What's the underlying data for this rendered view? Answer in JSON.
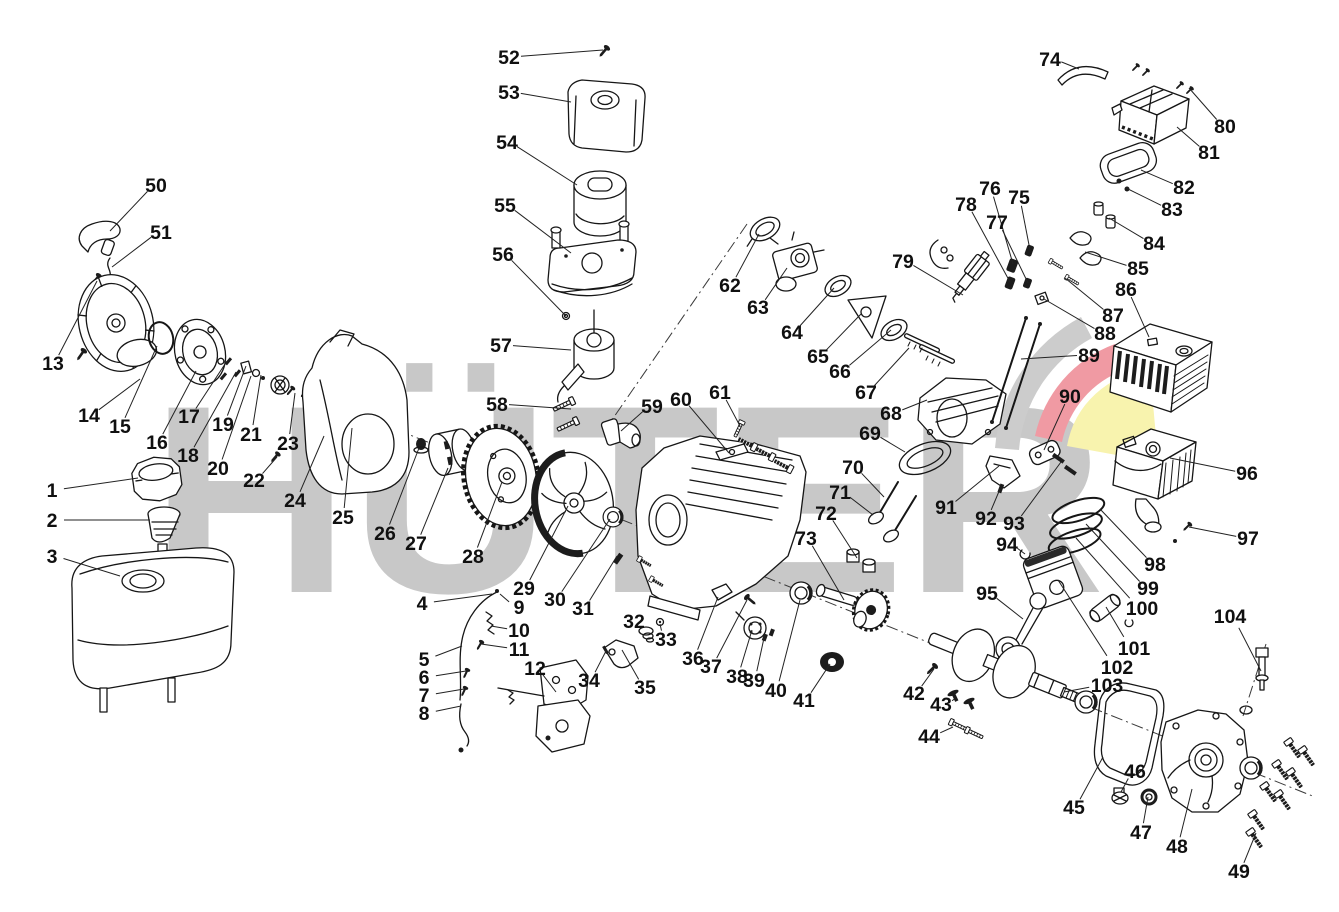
{
  "watermark": {
    "text": "HÜTER",
    "letter_color": "#c8c8c8",
    "fan_gray": "#cccccc",
    "fan_red": "#f09aa3",
    "fan_yellow": "#f8f3ae"
  },
  "diagram": {
    "type": "exploded-parts-diagram",
    "subject": "small gasoline engine",
    "background": "#ffffff",
    "line_color": "#161616",
    "part_count": 104
  },
  "labels": [
    {
      "n": "1",
      "x": 52,
      "y": 490,
      "tx": 138,
      "ty": 478
    },
    {
      "n": "2",
      "x": 52,
      "y": 520,
      "tx": 150,
      "ty": 520
    },
    {
      "n": "3",
      "x": 52,
      "y": 556,
      "tx": 120,
      "ty": 576
    },
    {
      "n": "4",
      "x": 422,
      "y": 603,
      "tx": 492,
      "ty": 594
    },
    {
      "n": "5",
      "x": 424,
      "y": 659,
      "tx": 462,
      "ty": 646
    },
    {
      "n": "6",
      "x": 424,
      "y": 677,
      "tx": 466,
      "ty": 671
    },
    {
      "n": "7",
      "x": 424,
      "y": 695,
      "tx": 464,
      "ty": 689
    },
    {
      "n": "8",
      "x": 424,
      "y": 713,
      "tx": 461,
      "ty": 706
    },
    {
      "n": "9",
      "x": 519,
      "y": 607,
      "tx": 500,
      "ty": 594
    },
    {
      "n": "10",
      "x": 519,
      "y": 630,
      "tx": 491,
      "ty": 626
    },
    {
      "n": "11",
      "x": 519,
      "y": 649,
      "tx": 481,
      "ty": 644
    },
    {
      "n": "12",
      "x": 535,
      "y": 668,
      "tx": 556,
      "ty": 692
    },
    {
      "n": "13",
      "x": 53,
      "y": 363,
      "tx": 97,
      "ty": 281
    },
    {
      "n": "14",
      "x": 89,
      "y": 415,
      "tx": 140,
      "ty": 379
    },
    {
      "n": "15",
      "x": 120,
      "y": 426,
      "tx": 157,
      "ty": 346
    },
    {
      "n": "16",
      "x": 157,
      "y": 442,
      "tx": 196,
      "ty": 371
    },
    {
      "n": "17",
      "x": 189,
      "y": 416,
      "tx": 227,
      "ty": 361
    },
    {
      "n": "18",
      "x": 188,
      "y": 455,
      "tx": 236,
      "ty": 372
    },
    {
      "n": "19",
      "x": 223,
      "y": 424,
      "tx": 246,
      "ty": 366
    },
    {
      "n": "20",
      "x": 218,
      "y": 468,
      "tx": 251,
      "ty": 376
    },
    {
      "n": "21",
      "x": 251,
      "y": 434,
      "tx": 261,
      "ty": 375
    },
    {
      "n": "22",
      "x": 254,
      "y": 480,
      "tx": 277,
      "ty": 457
    },
    {
      "n": "23",
      "x": 288,
      "y": 443,
      "tx": 295,
      "ty": 393
    },
    {
      "n": "24",
      "x": 295,
      "y": 500,
      "tx": 324,
      "ty": 436
    },
    {
      "n": "25",
      "x": 343,
      "y": 517,
      "tx": 352,
      "ty": 428
    },
    {
      "n": "26",
      "x": 385,
      "y": 533,
      "tx": 419,
      "ty": 448
    },
    {
      "n": "27",
      "x": 416,
      "y": 543,
      "tx": 448,
      "ty": 468
    },
    {
      "n": "28",
      "x": 473,
      "y": 556,
      "tx": 502,
      "ty": 482
    },
    {
      "n": "29",
      "x": 524,
      "y": 588,
      "tx": 568,
      "ty": 506
    },
    {
      "n": "30",
      "x": 555,
      "y": 599,
      "tx": 610,
      "ty": 519
    },
    {
      "n": "31",
      "x": 583,
      "y": 608,
      "tx": 617,
      "ty": 556
    },
    {
      "n": "32",
      "x": 634,
      "y": 621,
      "tx": 645,
      "ty": 632
    },
    {
      "n": "33",
      "x": 666,
      "y": 639,
      "tx": 660,
      "ty": 624
    },
    {
      "n": "34",
      "x": 589,
      "y": 680,
      "tx": 606,
      "ty": 651
    },
    {
      "n": "35",
      "x": 645,
      "y": 687,
      "tx": 622,
      "ty": 650
    },
    {
      "n": "36",
      "x": 693,
      "y": 658,
      "tx": 718,
      "ty": 597
    },
    {
      "n": "37",
      "x": 711,
      "y": 666,
      "tx": 747,
      "ty": 600
    },
    {
      "n": "38",
      "x": 737,
      "y": 676,
      "tx": 752,
      "ty": 630
    },
    {
      "n": "39",
      "x": 754,
      "y": 680,
      "tx": 764,
      "ty": 638
    },
    {
      "n": "40",
      "x": 776,
      "y": 690,
      "tx": 800,
      "ty": 600
    },
    {
      "n": "41",
      "x": 804,
      "y": 700,
      "tx": 830,
      "ty": 664
    },
    {
      "n": "42",
      "x": 914,
      "y": 693,
      "tx": 934,
      "ty": 669
    },
    {
      "n": "43",
      "x": 941,
      "y": 704,
      "tx": 956,
      "ty": 698
    },
    {
      "n": "44",
      "x": 929,
      "y": 736,
      "tx": 953,
      "ty": 727
    },
    {
      "n": "45",
      "x": 1074,
      "y": 807,
      "tx": 1103,
      "ty": 757
    },
    {
      "n": "46",
      "x": 1135,
      "y": 771,
      "tx": 1121,
      "ty": 792
    },
    {
      "n": "47",
      "x": 1141,
      "y": 832,
      "tx": 1148,
      "ty": 797
    },
    {
      "n": "48",
      "x": 1177,
      "y": 846,
      "tx": 1192,
      "ty": 789
    },
    {
      "n": "49",
      "x": 1239,
      "y": 871,
      "tx": 1256,
      "ty": 833
    },
    {
      "n": "50",
      "x": 156,
      "y": 185,
      "tx": 110,
      "ty": 231
    },
    {
      "n": "51",
      "x": 161,
      "y": 232,
      "tx": 112,
      "ty": 267
    },
    {
      "n": "52",
      "x": 509,
      "y": 57,
      "tx": 603,
      "ty": 50
    },
    {
      "n": "53",
      "x": 509,
      "y": 92,
      "tx": 571,
      "ty": 102
    },
    {
      "n": "54",
      "x": 507,
      "y": 142,
      "tx": 577,
      "ty": 185
    },
    {
      "n": "55",
      "x": 505,
      "y": 205,
      "tx": 571,
      "ty": 253
    },
    {
      "n": "56",
      "x": 503,
      "y": 254,
      "tx": 566,
      "ty": 316
    },
    {
      "n": "57",
      "x": 501,
      "y": 345,
      "tx": 571,
      "ty": 350
    },
    {
      "n": "58",
      "x": 497,
      "y": 404,
      "tx": 571,
      "ty": 409
    },
    {
      "n": "59",
      "x": 652,
      "y": 406,
      "tx": 621,
      "ty": 431
    },
    {
      "n": "60",
      "x": 681,
      "y": 399,
      "tx": 729,
      "ty": 453
    },
    {
      "n": "61",
      "x": 720,
      "y": 392,
      "tx": 740,
      "ty": 426
    },
    {
      "n": "62",
      "x": 730,
      "y": 285,
      "tx": 759,
      "ty": 234
    },
    {
      "n": "63",
      "x": 758,
      "y": 307,
      "tx": 787,
      "ty": 268
    },
    {
      "n": "64",
      "x": 792,
      "y": 332,
      "tx": 834,
      "ty": 288
    },
    {
      "n": "65",
      "x": 818,
      "y": 356,
      "tx": 861,
      "ty": 314
    },
    {
      "n": "66",
      "x": 840,
      "y": 371,
      "tx": 891,
      "ty": 330
    },
    {
      "n": "67",
      "x": 866,
      "y": 392,
      "tx": 909,
      "ty": 348
    },
    {
      "n": "68",
      "x": 891,
      "y": 413,
      "tx": 927,
      "ty": 400
    },
    {
      "n": "69",
      "x": 870,
      "y": 433,
      "tx": 905,
      "ty": 452
    },
    {
      "n": "70",
      "x": 853,
      "y": 467,
      "tx": 884,
      "ty": 497
    },
    {
      "n": "71",
      "x": 840,
      "y": 492,
      "tx": 873,
      "ty": 515
    },
    {
      "n": "72",
      "x": 826,
      "y": 513,
      "tx": 857,
      "ty": 558
    },
    {
      "n": "73",
      "x": 806,
      "y": 538,
      "tx": 844,
      "ty": 600
    },
    {
      "n": "74",
      "x": 1050,
      "y": 59,
      "tx": 1079,
      "ty": 69
    },
    {
      "n": "75",
      "x": 1019,
      "y": 197,
      "tx": 1030,
      "ty": 250
    },
    {
      "n": "76",
      "x": 990,
      "y": 188,
      "tx": 1013,
      "ty": 264
    },
    {
      "n": "77",
      "x": 997,
      "y": 222,
      "tx": 1028,
      "ty": 283
    },
    {
      "n": "78",
      "x": 966,
      "y": 204,
      "tx": 1010,
      "ty": 282
    },
    {
      "n": "79",
      "x": 903,
      "y": 261,
      "tx": 963,
      "ty": 295
    },
    {
      "n": "80",
      "x": 1225,
      "y": 126,
      "tx": 1189,
      "ty": 88
    },
    {
      "n": "81",
      "x": 1209,
      "y": 152,
      "tx": 1177,
      "ty": 127
    },
    {
      "n": "82",
      "x": 1184,
      "y": 187,
      "tx": 1141,
      "ty": 170
    },
    {
      "n": "83",
      "x": 1172,
      "y": 209,
      "tx": 1126,
      "ty": 188
    },
    {
      "n": "84",
      "x": 1154,
      "y": 243,
      "tx": 1109,
      "ty": 218
    },
    {
      "n": "85",
      "x": 1138,
      "y": 268,
      "tx": 1085,
      "ty": 252
    },
    {
      "n": "86",
      "x": 1126,
      "y": 289,
      "tx": 1149,
      "ty": 337
    },
    {
      "n": "87",
      "x": 1113,
      "y": 315,
      "tx": 1065,
      "ty": 278
    },
    {
      "n": "88",
      "x": 1105,
      "y": 333,
      "tx": 1044,
      "ty": 299
    },
    {
      "n": "89",
      "x": 1089,
      "y": 355,
      "tx": 1021,
      "ty": 359
    },
    {
      "n": "90",
      "x": 1070,
      "y": 396,
      "tx": 1044,
      "ty": 450
    },
    {
      "n": "91",
      "x": 946,
      "y": 507,
      "tx": 999,
      "ty": 466
    },
    {
      "n": "92",
      "x": 986,
      "y": 518,
      "tx": 1000,
      "ty": 489
    },
    {
      "n": "93",
      "x": 1014,
      "y": 523,
      "tx": 1061,
      "ty": 462
    },
    {
      "n": "94",
      "x": 1007,
      "y": 544,
      "tx": 1025,
      "ty": 554
    },
    {
      "n": "95",
      "x": 987,
      "y": 593,
      "tx": 1023,
      "ty": 619
    },
    {
      "n": "96",
      "x": 1247,
      "y": 473,
      "tx": 1170,
      "ty": 458
    },
    {
      "n": "97",
      "x": 1248,
      "y": 538,
      "tx": 1189,
      "ty": 527
    },
    {
      "n": "98",
      "x": 1155,
      "y": 564,
      "tx": 1100,
      "ty": 509
    },
    {
      "n": "99",
      "x": 1148,
      "y": 588,
      "tx": 1086,
      "ty": 524
    },
    {
      "n": "100",
      "x": 1142,
      "y": 608,
      "tx": 1076,
      "ty": 538
    },
    {
      "n": "101",
      "x": 1134,
      "y": 648,
      "tx": 1106,
      "ty": 607
    },
    {
      "n": "102",
      "x": 1117,
      "y": 667,
      "tx": 1058,
      "ty": 580
    },
    {
      "n": "103",
      "x": 1107,
      "y": 685,
      "tx": 1064,
      "ty": 692
    },
    {
      "n": "104",
      "x": 1230,
      "y": 616,
      "tx": 1261,
      "ty": 671
    }
  ]
}
